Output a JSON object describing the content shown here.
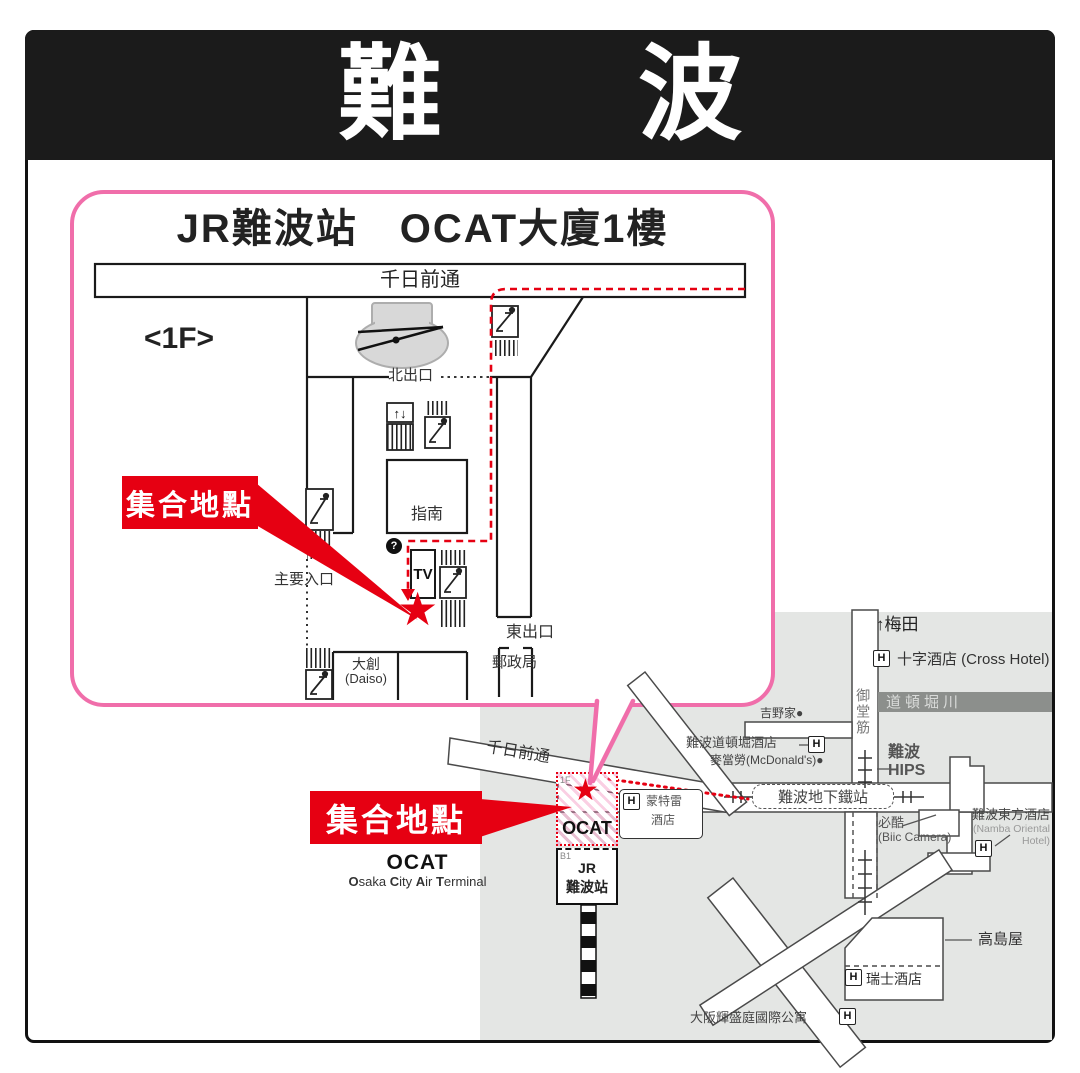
{
  "window": {
    "title_left": "難",
    "title_right": "波"
  },
  "floor_panel": {
    "title": "JR難波站　OCAT大廈1樓",
    "street": "千日前通",
    "floor": "<1F>",
    "north_exit": "北出口",
    "east_exit": "東出口",
    "main_entrance": "主要入口",
    "info": "指南",
    "info_mark": "?",
    "tv": "TV",
    "post_office": "郵政局",
    "daiso_zh": "大創",
    "daiso_en": "(Daiso)"
  },
  "meeting": {
    "label": "集合地點"
  },
  "map": {
    "umeda": "↑梅田",
    "hotel_mark": "H",
    "cross_hotel": "十字酒店 (Cross Hotel)",
    "river": "道頓堀川",
    "yoshinoya": "吉野家●",
    "midosuji": "御堂筋",
    "dotonbori_hotel": "難波道頓堀酒店",
    "mcdonalds": "麥當勞(McDonald's)●",
    "hips_zh": "難波",
    "hips_en": "HIPS",
    "subway_station": "難波地下鐵站",
    "bic_zh": "必酷",
    "bic_en": "(Biic Camera)",
    "oriental_zh": "難波東方酒店",
    "oriental_en1": "(Namba Oriental",
    "oriental_en2": "Hotel)",
    "takashimaya": "高島屋",
    "swissotel": "瑞士酒店",
    "fraser": "大阪輝盛庭國際公寓",
    "sennichimae": "千日前通",
    "monterey_l1": "蒙特雷",
    "monterey_l2": "酒店",
    "ocat": "OCAT",
    "ocat_floor": "1F",
    "jr_floor": "B1",
    "jr_l1": "JR",
    "jr_l2": "難波站",
    "ocat_caption": "OCAT",
    "ocat_caption_en": [
      "O",
      "saka ",
      "C",
      "ity ",
      "A",
      "ir ",
      "T",
      "erminal"
    ]
  },
  "icons": {
    "star": "★",
    "elevator_arrows": "↑↓"
  },
  "colors": {
    "accent_red": "#E60012",
    "panel_pink": "#F06EAA",
    "map_bg": "#E4E6E4",
    "river_gray": "#8C8F8C",
    "band_black": "#1B1B1B"
  }
}
